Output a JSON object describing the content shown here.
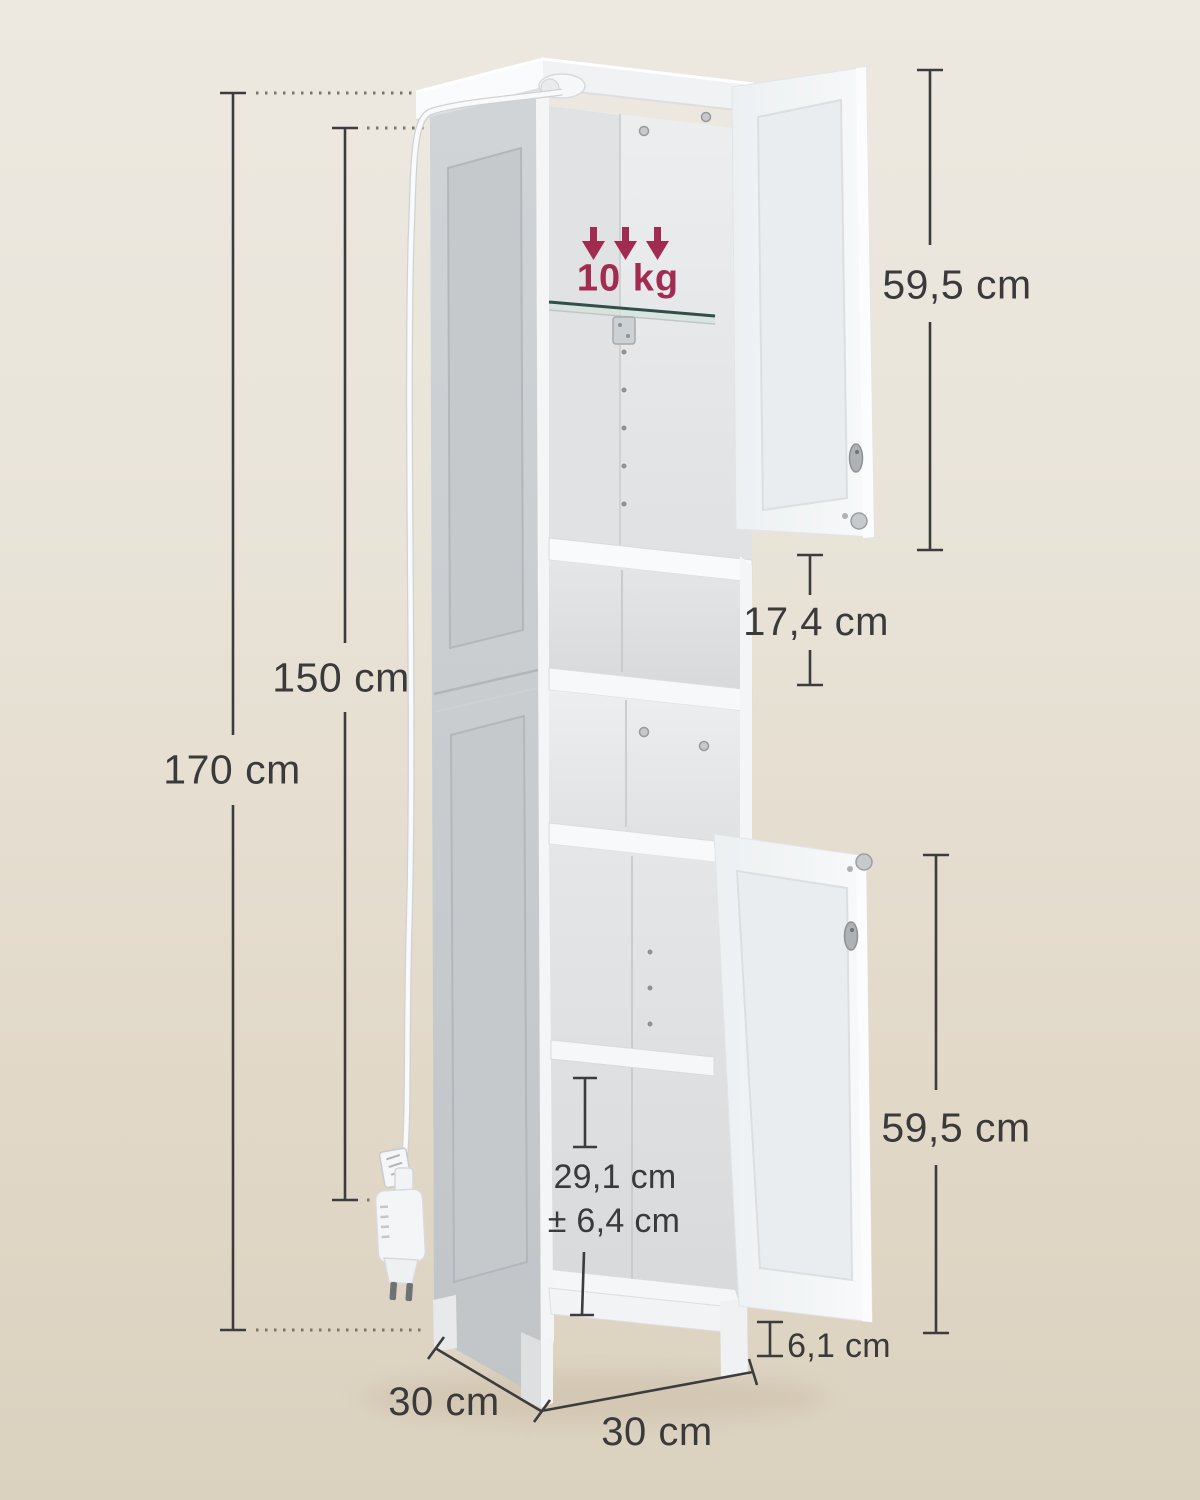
{
  "diagram": {
    "product": "tall-bathroom-cabinet-dimension-diagram",
    "load_capacity": "10 kg",
    "dimensions": {
      "total_height": "170 cm",
      "cabinet_height": "150 cm",
      "upper_door_height": "59,5 cm",
      "open_shelf_height": "17,4 cm",
      "lower_door_height": "59,5 cm",
      "adjustable_shelf_height": "29,1 cm",
      "adjustable_shelf_tolerance": "± 6,4 cm",
      "leg_height": "6,1 cm",
      "depth": "30 cm",
      "width": "30 cm"
    },
    "colors": {
      "background_top": "#EDE9E1",
      "background_bottom": "#DBD1BF",
      "accent_load": "#A22C4F",
      "dimension_line": "#3c3c3e",
      "cabinet_white": "#F4F6F7",
      "cabinet_side_gray": "#C9CDD1"
    }
  }
}
